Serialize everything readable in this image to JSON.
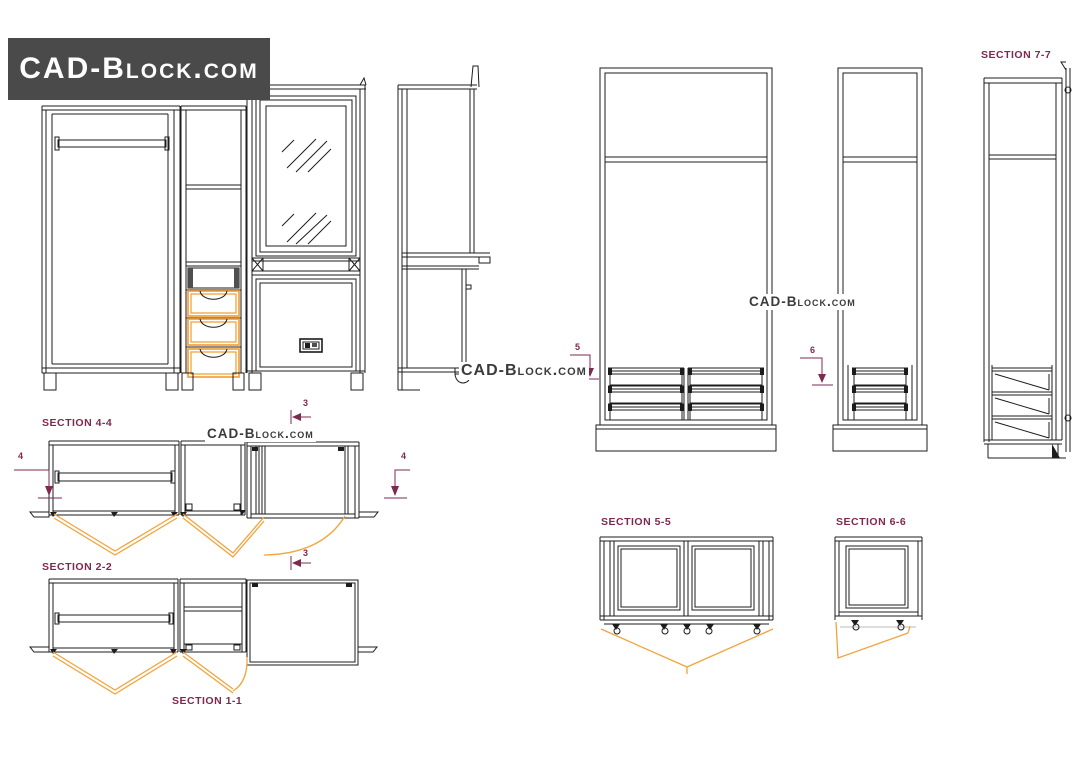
{
  "logo": {
    "text": "CAD-Block.com"
  },
  "watermarks": {
    "plan": "CAD-Block.com",
    "middle": "CAD-Block.com",
    "section": "CAD-Block.com"
  },
  "labels": {
    "section_4_4": "SECTION 4-4",
    "section_2_2": "SECTION 2-2",
    "section_1_1": "SECTION 1-1",
    "section_5_5": "SECTION 5-5",
    "section_6_6": "SECTION 6-6",
    "section_7_7": "SECTION 7-7"
  },
  "markers": {
    "left_4": "4",
    "right_4": "4",
    "top_3": "3",
    "mid_3": "3",
    "cut_5": "5",
    "cut_6": "6"
  },
  "colors": {
    "line": "#1c1c1c",
    "accent_orange": "#F2A33C",
    "label_maroon": "#7E2950",
    "logo_background": "#4a4a4a",
    "logo_text": "#ffffff",
    "watermark_gray": "#3b3b3b"
  }
}
